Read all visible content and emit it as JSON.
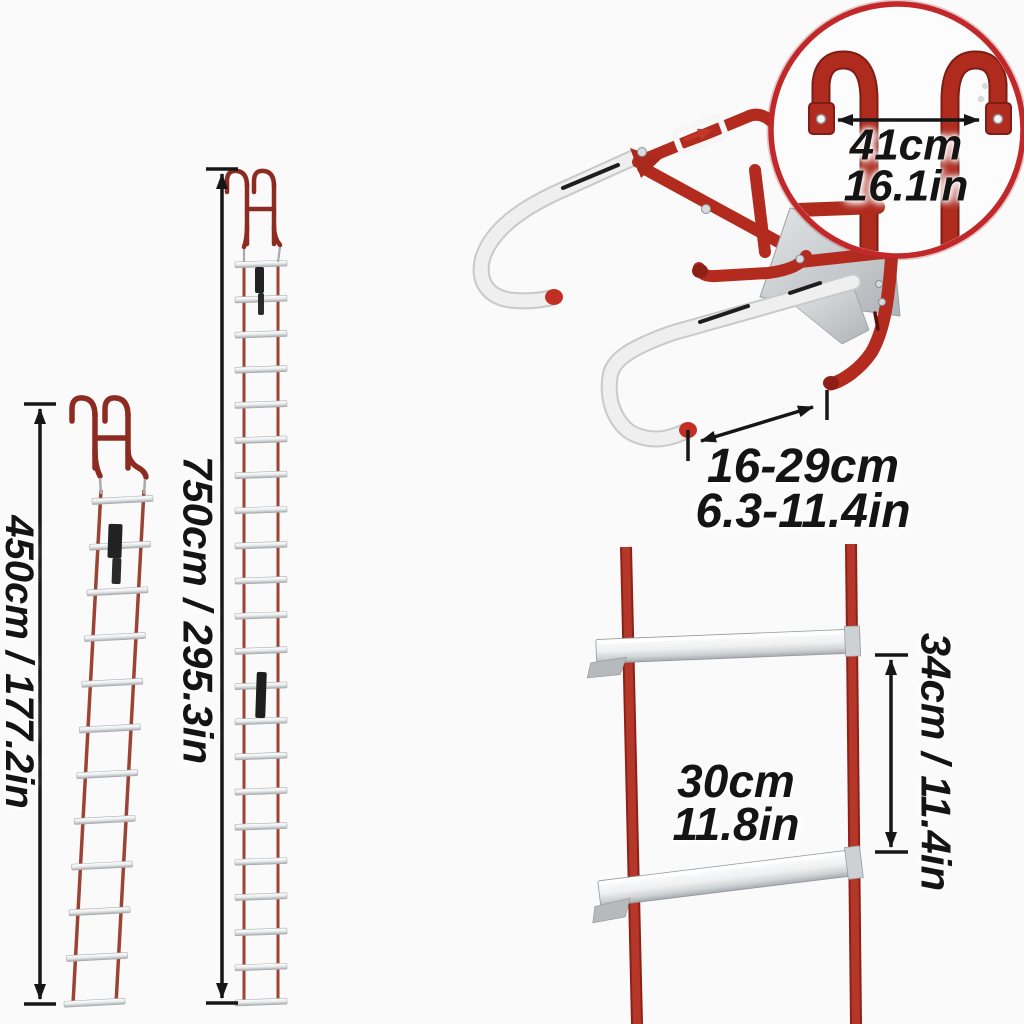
{
  "page": {
    "background": "#fbfafa"
  },
  "colors": {
    "frame_red": "#b22b1e",
    "ring_red": "#c2282a",
    "rail_red": "#9b4434",
    "silver": "#c7cacd",
    "text": "#141414",
    "arrow": "#161616"
  },
  "annotations": {
    "ladder_450_length": "450cm / 177.2in",
    "ladder_750_length": "750cm / 295.3in",
    "hook_span": {
      "cm": "41cm",
      "in": "16.1in"
    },
    "standoff_depth": {
      "cm": "16-29cm",
      "in": "6.3-11.4in"
    },
    "rung_width": {
      "cm": "30cm",
      "in": "11.8in"
    },
    "rung_spacing": "34cm / 11.4in"
  },
  "ladders": {
    "l450": {
      "rung_count": 12
    },
    "l750": {
      "rung_count": 22
    }
  }
}
